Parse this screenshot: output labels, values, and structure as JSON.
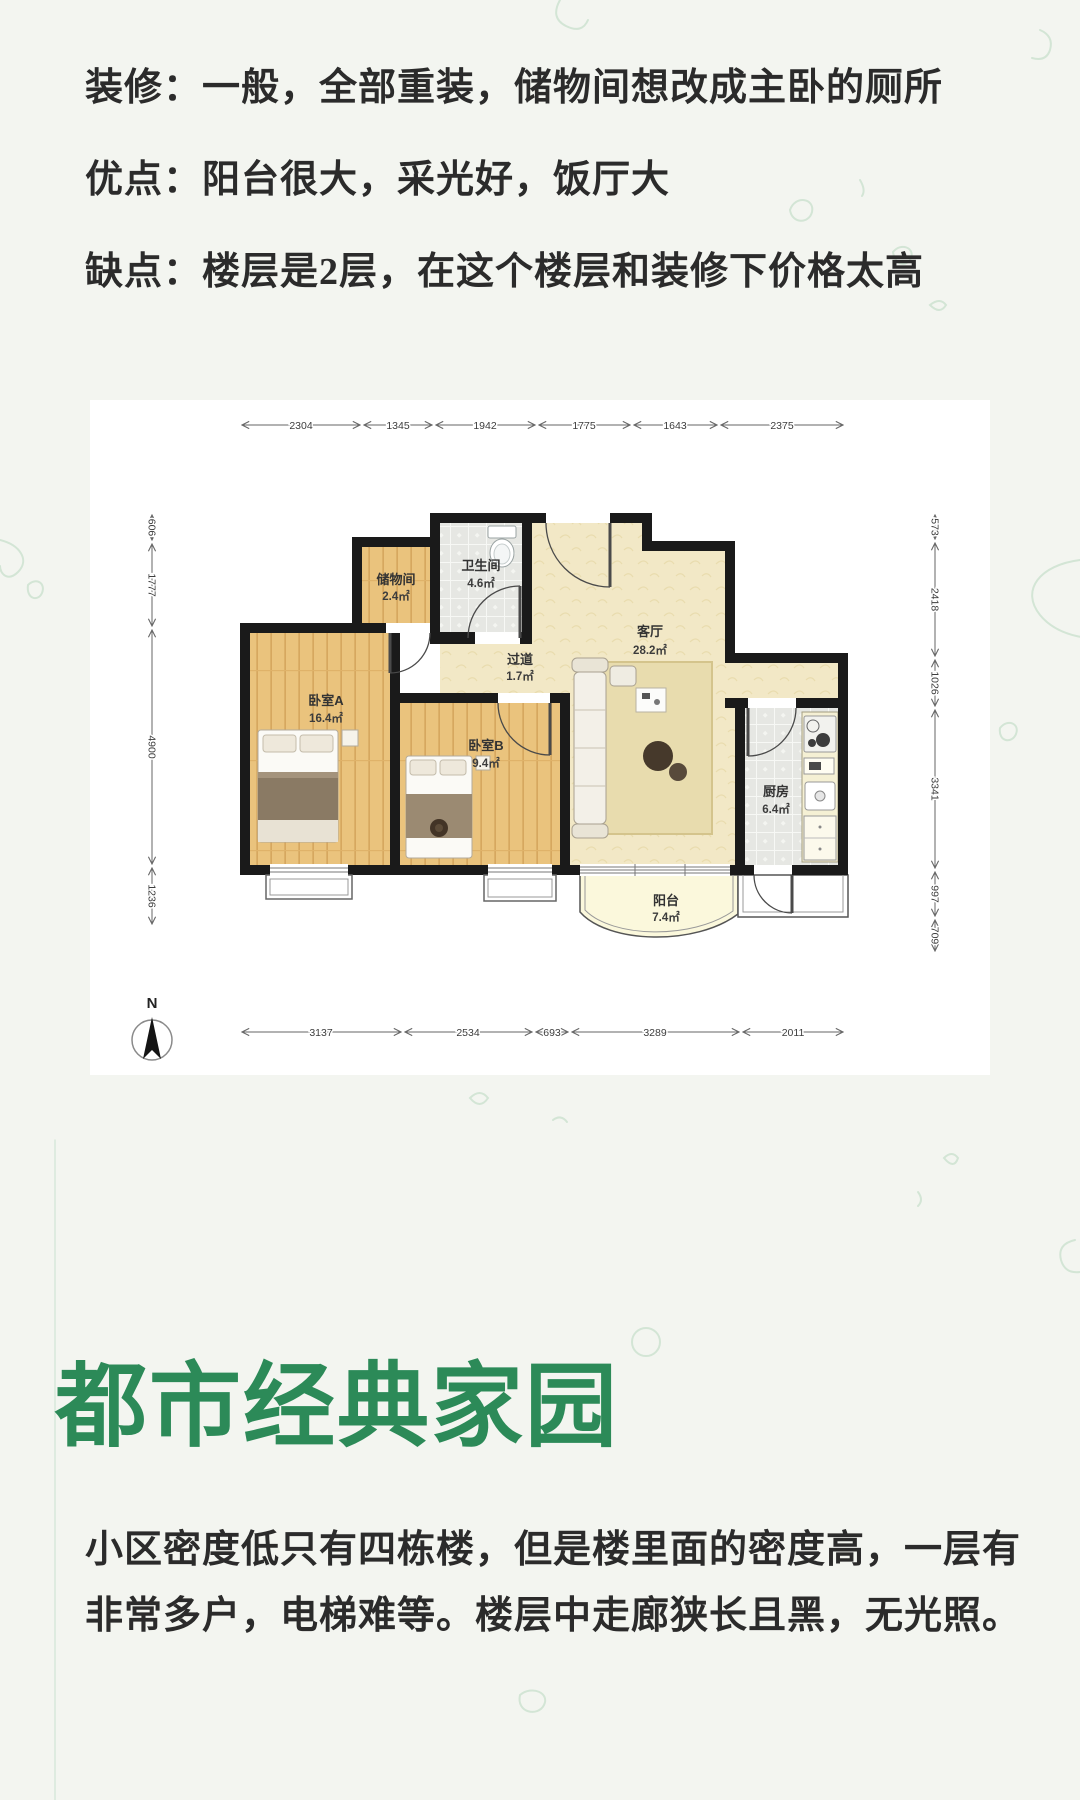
{
  "colors": {
    "title_green": "#2c8a58",
    "body_text": "#2b2b2b",
    "wall_black": "#1a1a1a",
    "wood_floor": "#eac37d",
    "living_floor": "#f2e8c6",
    "tile_floor": "#e6e7e3",
    "balcony_floor": "#fbf8dc",
    "page_background": "#f3f5f0",
    "panel_background": "#ffffff"
  },
  "notes": {
    "line1": "装修：一般，全部重装，储物间想改成主卧的厕所",
    "line2": "优点：阳台很大，采光好，饭厅大",
    "line3": "缺点：楼层是2层，在这个楼层和装修下价格太高"
  },
  "community": {
    "name": "都市经典家园",
    "review_line1": "小区密度低只有四栋楼，但是楼里面的密度高，一层有",
    "review_line2": "非常多户，电梯难等。楼层中走廊狭长且黑，无光照。"
  },
  "floorplan": {
    "compass_label": "N",
    "rooms": [
      {
        "name": "储物间",
        "area": "2.4㎡"
      },
      {
        "name": "卫生间",
        "area": "4.6㎡"
      },
      {
        "name": "过道",
        "area": "1.7㎡"
      },
      {
        "name": "客厅",
        "area": "28.2㎡"
      },
      {
        "name": "卧室A",
        "area": "16.4㎡"
      },
      {
        "name": "卧室B",
        "area": "9.4㎡"
      },
      {
        "name": "厨房",
        "area": "6.4㎡"
      },
      {
        "name": "阳台",
        "area": "7.4㎡"
      }
    ],
    "dims_top": [
      "2304",
      "1345",
      "1942",
      "1775",
      "1643",
      "2375"
    ],
    "dims_bottom": [
      "3137",
      "2534",
      "693",
      "3289",
      "2011"
    ],
    "dims_left": [
      "606",
      "1777",
      "4900",
      "1236"
    ],
    "dims_right": [
      "573",
      "2418",
      "1026",
      "3341",
      "997",
      "709"
    ]
  }
}
